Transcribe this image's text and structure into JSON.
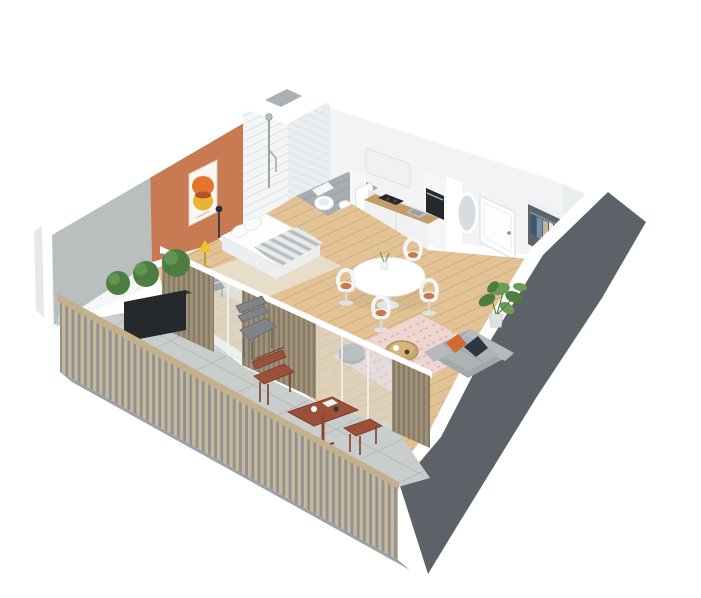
{
  "meta": {
    "kind": "isometric-3d-floorplan-render",
    "description": "3D cutaway floor plan of a studio apartment with wrap balcony",
    "background": "#ffffff"
  },
  "palette": {
    "bg": "#ffffff",
    "wallTop": "#ffffff",
    "wallFace": "#f4f6f7",
    "wallFaceShade": "#e9edee",
    "wallInnerNE": "#f1f3f4",
    "darkWall": "#5d6269",
    "concrete": "#b9bebf",
    "outerSliver": "#e6e9ea",
    "terracotta": "#c87a52",
    "artFrame": "#f9f6ef",
    "artOrange": "#e4762b",
    "artYellow": "#eab433",
    "artOverlap": "#b0532a",
    "tile": "#f3f5f6",
    "tileLine": "#dde2e4",
    "tileSide": "#eaeef0",
    "chrome": "#9aa2a7",
    "fixtureLine": "#d4dadd",
    "bathFloor": "#a6acaf",
    "bathFloorLine": "#959ca0",
    "woodFloor": "#e3c396",
    "woodLine": "#d3ae7c",
    "rugBeige": "#e8ddc8",
    "rugPink": "#eed6d1",
    "rugPinkLine": "#dfb0aa",
    "counterWood": "#c59b68",
    "appliance": "#26292c",
    "steel": "#bac0c4",
    "steelDark": "#99a1a6",
    "fridge": "#99a0a5",
    "cabinet": "#eff1f3",
    "door": "#fcfdfd",
    "doorLine": "#dde1e5",
    "handle": "#8a9197",
    "mirror": "#d6dce0",
    "closet": "#5d636a",
    "clothNavy": "#3c5878",
    "clothDenim": "#7191ad",
    "clothTan": "#c7b68f",
    "clothLight": "#e8e8e6",
    "glassTint": "#d9e2e4",
    "taupeSlat": "#a09278",
    "taupeGap": "#877b68",
    "railSlat": "#c9b795",
    "railBase": "#8d9298",
    "railTop": "#c3b18d",
    "slab": "#9aa0a6",
    "balconyFloor": "#c9cecd",
    "balconyLine": "#b6bbba",
    "planter": "#26292b",
    "leaf": "#4e7d42",
    "leafLight": "#6b9c58",
    "metal": "#7e8488",
    "metalDark": "#656a6e",
    "bistro": "#9c4f39",
    "bistroDark": "#7a3e2e",
    "sofa": "#a3a8ab",
    "sofaLight": "#b6babd",
    "sofaSeat": "#aeb3b6",
    "pillowOrange": "#d2692e",
    "pillowNavy": "#2d3743",
    "pouf": "#9fa4a7",
    "rattan": "#c8a76d",
    "rattanDark": "#b2905c",
    "chairShell": "#f3f5f6",
    "chairCushion": "#c9794f",
    "chairLeg": "#d8dbdc",
    "mattress": "#fcfdfe",
    "blanket": "#b9bec1",
    "bedSide": "#eceef0",
    "lampYellow": "#f0c12f",
    "lampDark": "#2b2e31",
    "deskChair": "#585e63"
  },
  "scene": {
    "rooms": [
      {
        "name": "bedroom",
        "features": [
          "terracotta accent wall",
          "abstract circle artwork",
          "single bed with striped blanket",
          "yellow floor lamp",
          "black floor lamp",
          "desk chair",
          "beige rug"
        ]
      },
      {
        "name": "bathroom",
        "features": [
          "tiled walk-in shower",
          "shower column",
          "wall-hung toilet",
          "washbasin",
          "gray tile floor"
        ]
      },
      {
        "name": "kitchen",
        "features": [
          "wood countertop",
          "black cooktop",
          "steel sink",
          "built-in oven",
          "mini fridge",
          "upper cabinet"
        ]
      },
      {
        "name": "living-dining",
        "features": [
          "round pedestal table",
          "four tulip chairs with terracotta cushions",
          "gray sofa",
          "orange cushion",
          "navy cushion",
          "rattan coffee table",
          "gray pouf",
          "pink patterned rug",
          "monstera plant",
          "oak plank floor"
        ]
      },
      {
        "name": "entry",
        "features": [
          "white front door",
          "oval mirror",
          "open wardrobe with hanging clothes"
        ]
      },
      {
        "name": "balcony",
        "features": [
          "wood slat railing",
          "concrete tile floor",
          "black planter with three topiary balls",
          "gray folding chair",
          "bistro table",
          "bistro chair",
          "bistro stool",
          "glass sliding doors",
          "taupe slat partitions"
        ]
      }
    ]
  }
}
